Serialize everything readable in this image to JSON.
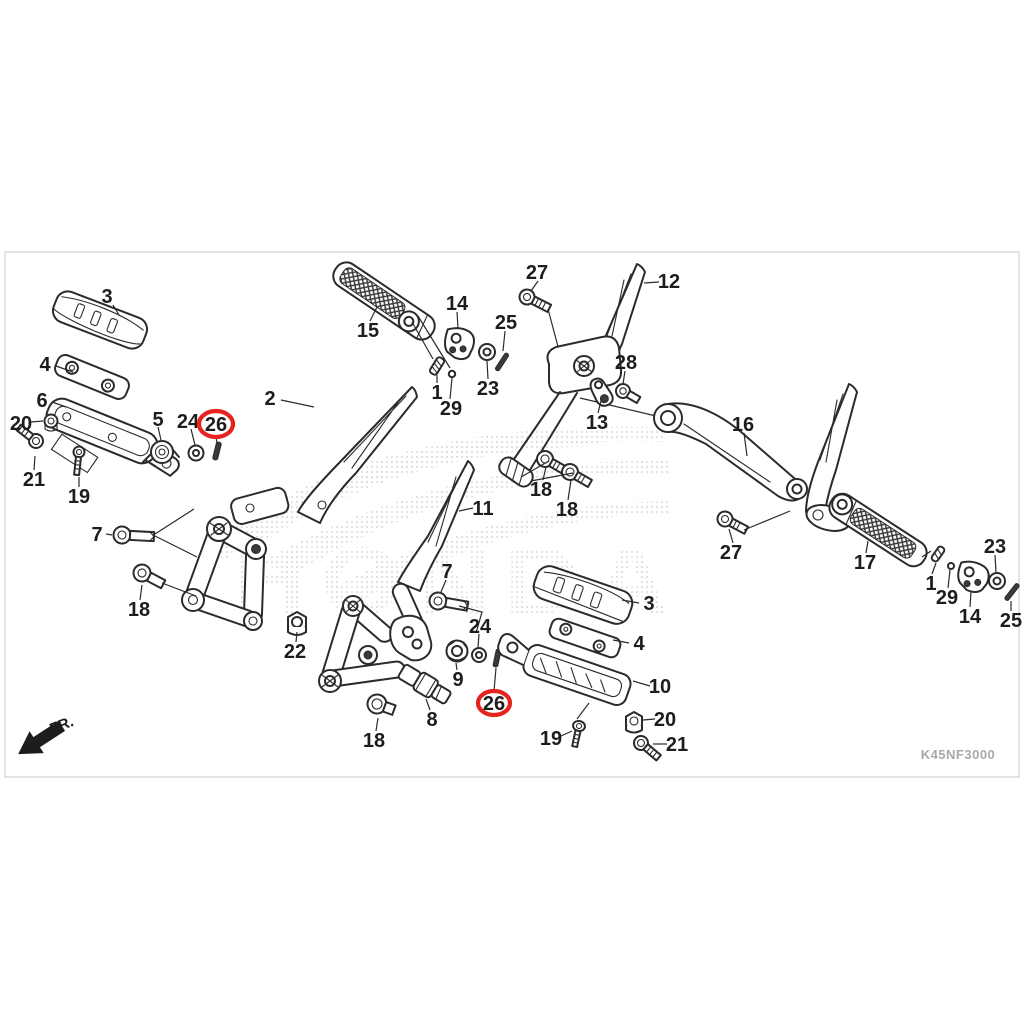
{
  "meta": {
    "diagram_code": "K45NF3000",
    "front_label": "FR.",
    "watermark_text": "HONDA"
  },
  "colors": {
    "line": "#2b2b2b",
    "label": "#1d1d1d",
    "highlight": "#e5231f",
    "frame": "#dcdcdc",
    "code_text": "#a8a8a8",
    "watermark": "#bdbdbd",
    "background": "#ffffff"
  },
  "callouts": [
    {
      "label": "3",
      "x": 107,
      "y": 296,
      "leader": [
        113,
        305,
        119,
        315
      ]
    },
    {
      "label": "4",
      "x": 45,
      "y": 364,
      "leader": [
        56,
        366,
        73,
        372
      ]
    },
    {
      "label": "6",
      "x": 42,
      "y": 400,
      "leader": [
        52,
        402,
        66,
        407
      ]
    },
    {
      "label": "20",
      "x": 21,
      "y": 423,
      "leader": [
        31,
        422,
        43,
        421
      ]
    },
    {
      "label": "21",
      "x": 34,
      "y": 479,
      "leader": [
        34,
        470,
        35,
        456
      ]
    },
    {
      "label": "19",
      "x": 79,
      "y": 496,
      "leader": [
        79,
        487,
        79,
        477
      ]
    },
    {
      "label": "5",
      "x": 158,
      "y": 419,
      "leader": [
        158,
        427,
        161,
        440
      ]
    },
    {
      "label": "24",
      "x": 188,
      "y": 421,
      "leader": [
        191,
        429,
        195,
        445
      ]
    },
    {
      "label": "2",
      "x": 270,
      "y": 398,
      "leader": [
        281,
        400,
        314,
        407
      ]
    },
    {
      "label": "15",
      "x": 368,
      "y": 330,
      "leader": [
        370,
        321,
        377,
        307
      ]
    },
    {
      "label": "14",
      "x": 457,
      "y": 303,
      "leader": [
        457,
        312,
        458,
        328
      ]
    },
    {
      "label": "25",
      "x": 506,
      "y": 322,
      "leader": [
        505,
        331,
        503,
        351
      ]
    },
    {
      "label": "1",
      "x": 437,
      "y": 392,
      "leader": [
        437,
        383,
        437,
        375
      ]
    },
    {
      "label": "29",
      "x": 451,
      "y": 408,
      "leader": [
        450,
        399,
        452,
        378
      ]
    },
    {
      "label": "23",
      "x": 488,
      "y": 388,
      "leader": [
        488,
        379,
        487,
        361
      ]
    },
    {
      "label": "27",
      "x": 537,
      "y": 272,
      "leader": [
        538,
        281,
        531,
        291
      ]
    },
    {
      "label": "12",
      "x": 669,
      "y": 281,
      "leader": [
        659,
        282,
        644,
        283
      ]
    },
    {
      "label": "28",
      "x": 626,
      "y": 362,
      "leader": [
        625,
        371,
        623,
        384
      ]
    },
    {
      "label": "13",
      "x": 597,
      "y": 422,
      "leader": [
        598,
        413,
        601,
        401
      ]
    },
    {
      "label": "18",
      "x": 541,
      "y": 489,
      "leader": [
        543,
        480,
        546,
        467
      ]
    },
    {
      "label": "18",
      "x": 567,
      "y": 509,
      "leader": [
        568,
        500,
        571,
        480
      ]
    },
    {
      "label": "16",
      "x": 743,
      "y": 424,
      "leader": [
        744,
        433,
        747,
        456
      ]
    },
    {
      "label": "27",
      "x": 731,
      "y": 552,
      "leader": [
        733,
        543,
        729,
        529
      ]
    },
    {
      "label": "17",
      "x": 865,
      "y": 562,
      "leader": [
        866,
        553,
        868,
        541
      ]
    },
    {
      "label": "23",
      "x": 995,
      "y": 546,
      "leader": [
        995,
        555,
        996,
        572
      ]
    },
    {
      "label": "1",
      "x": 931,
      "y": 583,
      "leader": [
        932,
        574,
        936,
        563
      ]
    },
    {
      "label": "29",
      "x": 947,
      "y": 597,
      "leader": [
        948,
        588,
        950,
        570
      ]
    },
    {
      "label": "14",
      "x": 970,
      "y": 616,
      "leader": [
        970,
        607,
        971,
        592
      ]
    },
    {
      "label": "25",
      "x": 1011,
      "y": 620,
      "leader": [
        1011,
        611,
        1011,
        601
      ]
    },
    {
      "label": "11",
      "x": 483,
      "y": 508,
      "leader": [
        473,
        508,
        459,
        511
      ]
    },
    {
      "label": "7",
      "x": 97,
      "y": 534,
      "leader": [
        106,
        534,
        112,
        535
      ]
    },
    {
      "label": "18",
      "x": 139,
      "y": 609,
      "leader": [
        140,
        600,
        142,
        585
      ]
    },
    {
      "label": "7",
      "x": 447,
      "y": 571,
      "leader": [
        446,
        580,
        441,
        592
      ]
    },
    {
      "label": "22",
      "x": 295,
      "y": 651,
      "leader": [
        296,
        642,
        297,
        632
      ]
    },
    {
      "label": "24",
      "x": 480,
      "y": 626,
      "leader": [
        479,
        634,
        478,
        647
      ]
    },
    {
      "label": "9",
      "x": 458,
      "y": 679,
      "leader": [
        457,
        670,
        456,
        663
      ]
    },
    {
      "label": "8",
      "x": 432,
      "y": 719,
      "leader": [
        430,
        710,
        426,
        699
      ]
    },
    {
      "label": "18",
      "x": 374,
      "y": 740,
      "leader": [
        376,
        731,
        378,
        718
      ]
    },
    {
      "label": "3",
      "x": 649,
      "y": 603,
      "leader": [
        639,
        603,
        622,
        600
      ]
    },
    {
      "label": "4",
      "x": 639,
      "y": 643,
      "leader": [
        629,
        643,
        613,
        640
      ]
    },
    {
      "label": "10",
      "x": 660,
      "y": 686,
      "leader": [
        650,
        686,
        633,
        681
      ]
    },
    {
      "label": "20",
      "x": 665,
      "y": 719,
      "leader": [
        655,
        719,
        643,
        720
      ]
    },
    {
      "label": "19",
      "x": 551,
      "y": 738,
      "leader": [
        561,
        736,
        572,
        731
      ]
    },
    {
      "label": "21",
      "x": 677,
      "y": 744,
      "leader": [
        667,
        744,
        653,
        744
      ]
    }
  ],
  "highlighted_callouts": [
    {
      "label": "26",
      "x": 216,
      "y": 424,
      "rx": 17,
      "ry": 13,
      "leader": [
        216,
        437,
        217,
        443
      ]
    },
    {
      "label": "26",
      "x": 494,
      "y": 703,
      "rx": 16,
      "ry": 12,
      "leader": [
        494,
        691,
        496,
        668
      ]
    }
  ]
}
